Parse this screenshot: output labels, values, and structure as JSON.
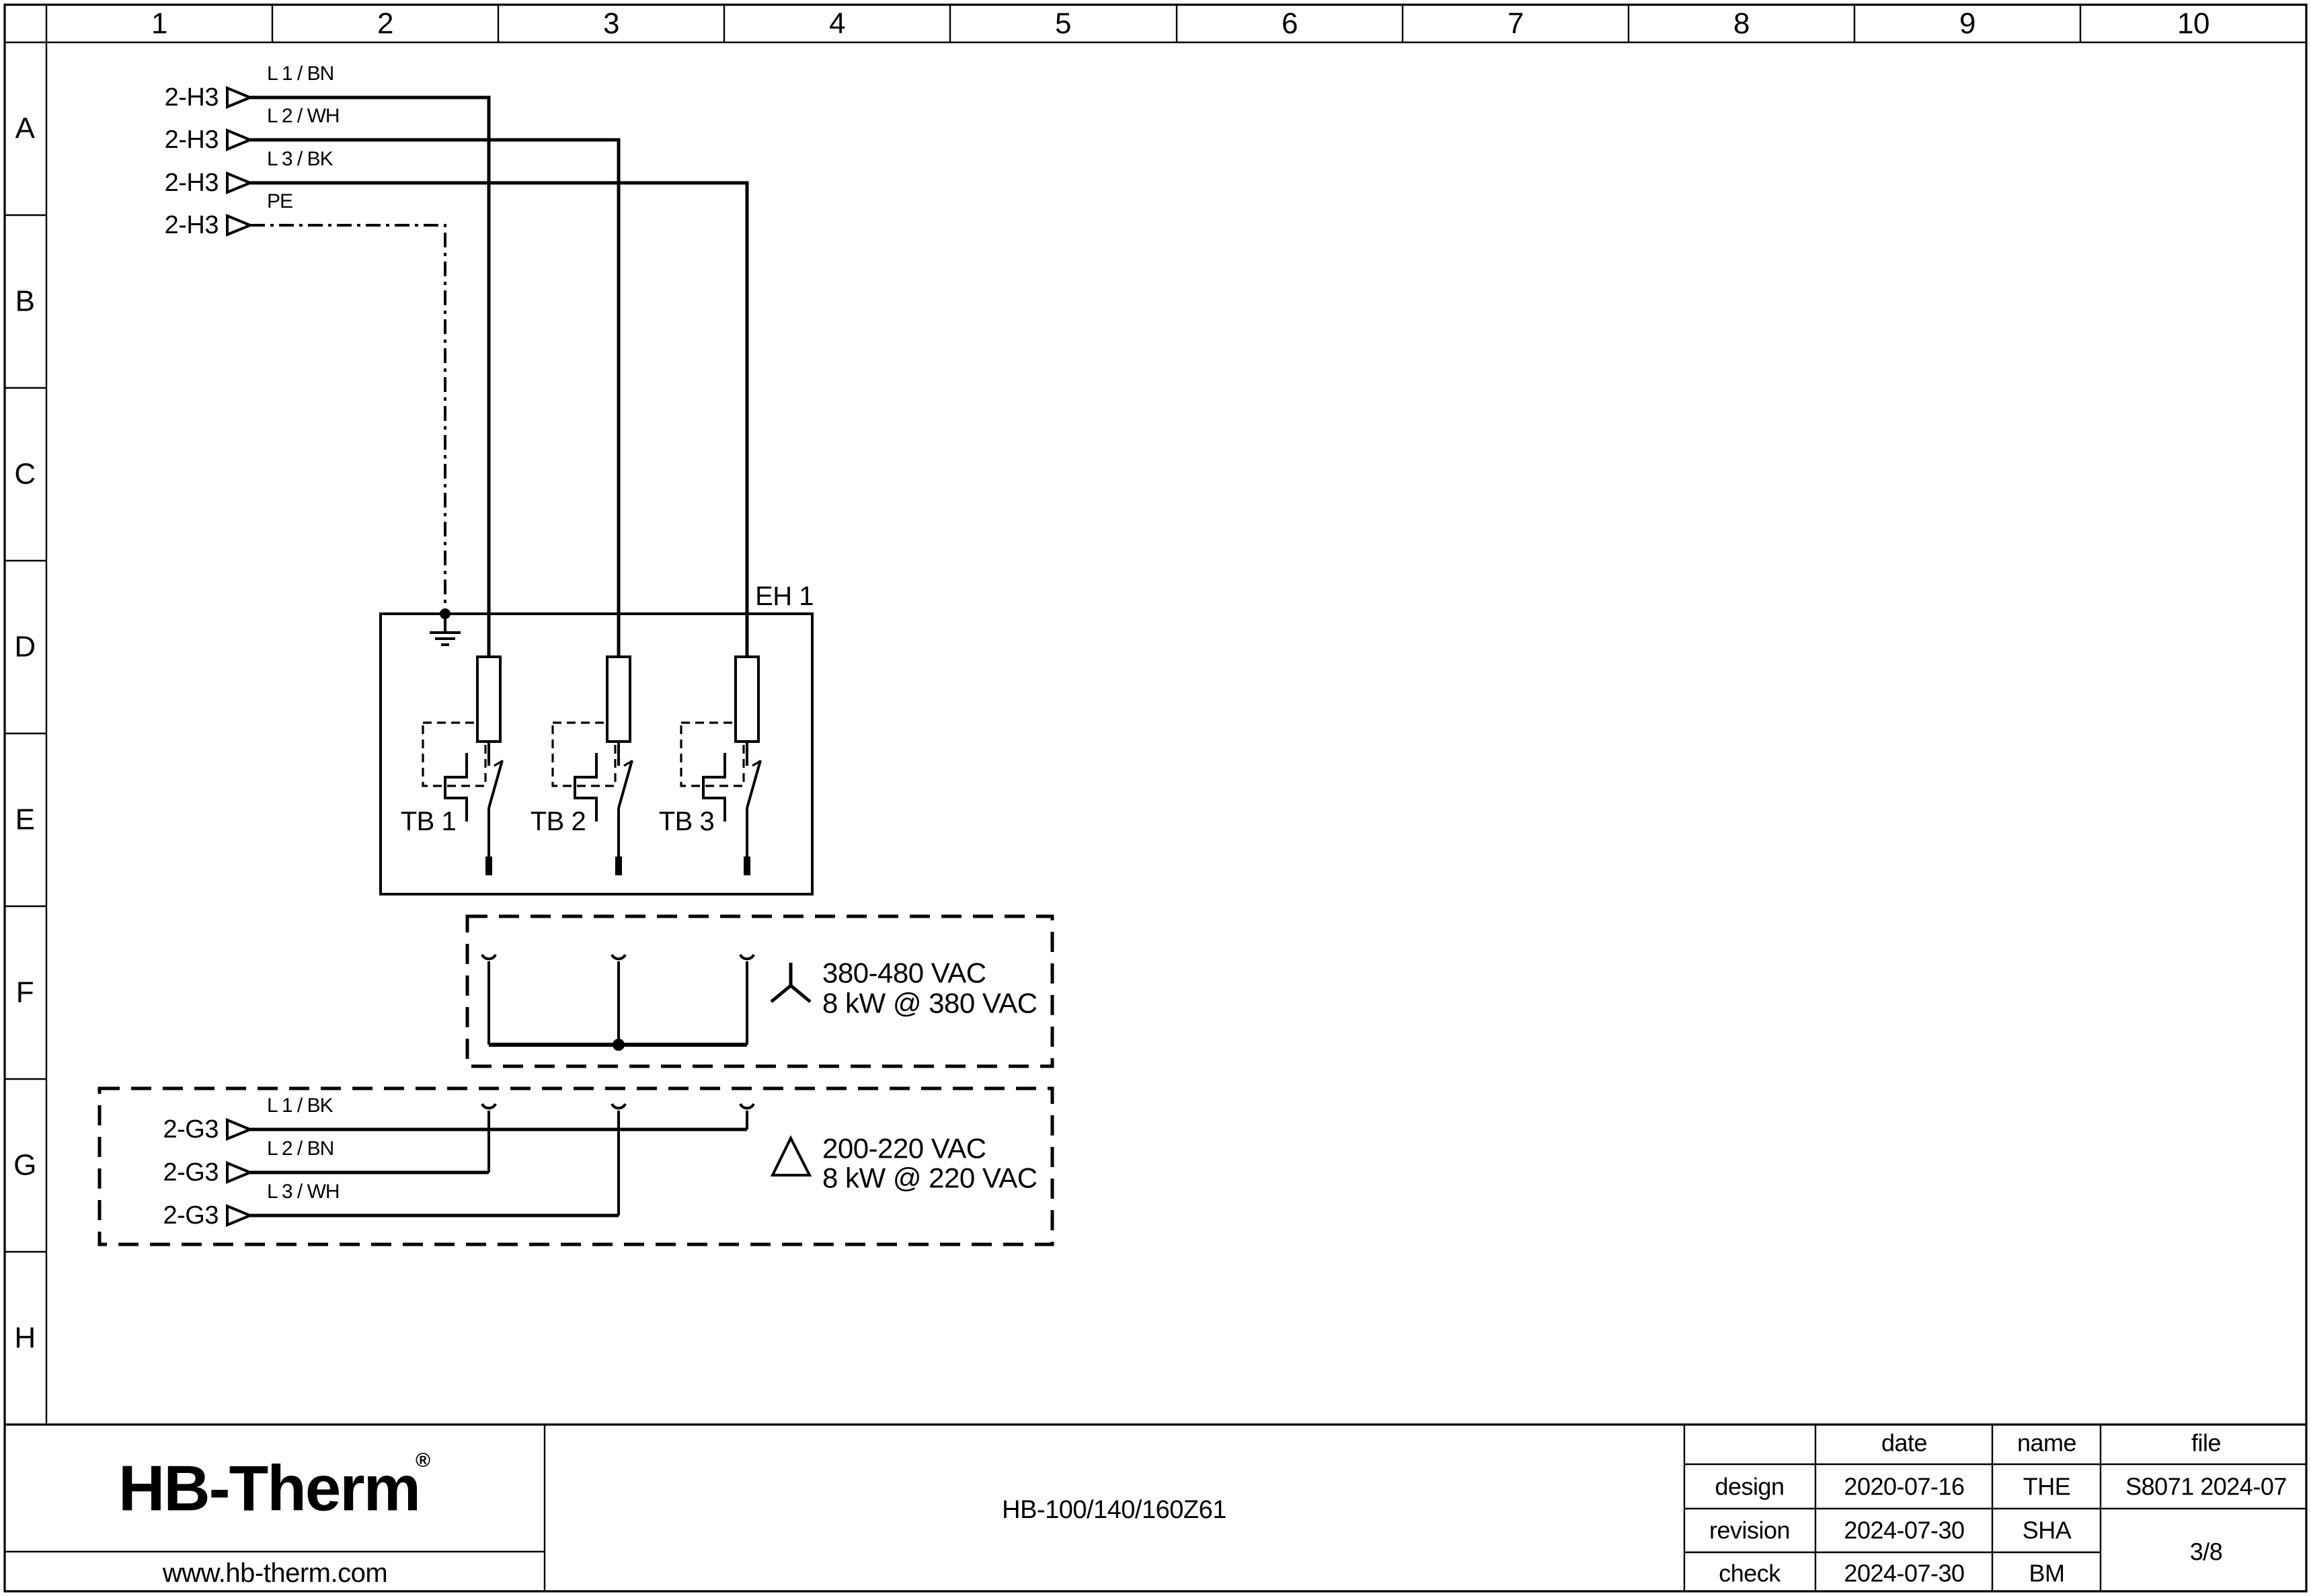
{
  "grid": {
    "columns": [
      "1",
      "2",
      "3",
      "4",
      "5",
      "6",
      "7",
      "8",
      "9",
      "10"
    ],
    "rows": [
      "A",
      "B",
      "C",
      "D",
      "E",
      "F",
      "G",
      "H"
    ]
  },
  "feeds_top": {
    "source_label": "2-H3",
    "wires": [
      {
        "label": "L 1 / BN"
      },
      {
        "label": "L 2 / WH"
      },
      {
        "label": "L 3 / BK"
      },
      {
        "label": "PE"
      }
    ]
  },
  "heater_box": {
    "label": "EH 1",
    "breakers": [
      {
        "label": "TB 1"
      },
      {
        "label": "TB 2"
      },
      {
        "label": "TB 3"
      }
    ]
  },
  "star_config": {
    "voltage": "380-480 VAC",
    "power": "8 kW @ 380 VAC"
  },
  "delta_config": {
    "source_label": "2-G3",
    "voltage": "200-220 VAC",
    "power": "8 kW @ 220 VAC",
    "wires": [
      {
        "label": "L 1 / BK"
      },
      {
        "label": "L 2 / BN"
      },
      {
        "label": "L 3 / WH"
      }
    ]
  },
  "title_block": {
    "logo_text": "HB-Therm",
    "logo_mark": "®",
    "website": "www.hb-therm.com",
    "drawing_title": "HB-100/140/160Z61",
    "col_date": "date",
    "col_name": "name",
    "col_file": "file",
    "rows": [
      {
        "label": "design",
        "date": "2020-07-16",
        "name": "THE"
      },
      {
        "label": "revision",
        "date": "2024-07-30",
        "name": "SHA"
      },
      {
        "label": "check",
        "date": "2024-07-30",
        "name": "BM"
      }
    ],
    "file_value": "S8071 2024-07",
    "page_number": "3/8"
  },
  "colors": {
    "line": "#000000",
    "dashed_box": "#9a9a9a",
    "logo": "#1d2945"
  }
}
